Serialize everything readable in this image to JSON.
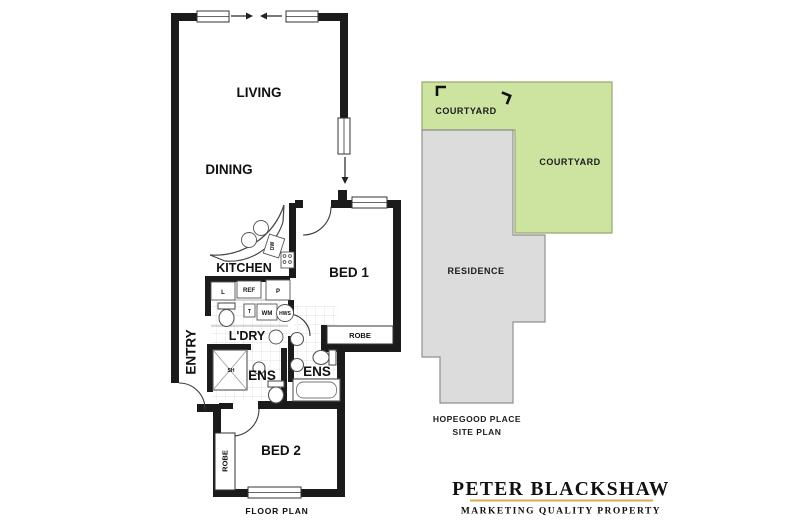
{
  "floor_plan": {
    "caption": "FLOOR PLAN",
    "rooms": {
      "living": "LIVING",
      "dining": "DINING",
      "kitchen": "KITCHEN",
      "entry": "ENTRY",
      "bed1": "BED 1",
      "bed1_robe": "ROBE",
      "laundry": "L'DRY",
      "ens1": "ENS",
      "ens2": "ENS",
      "bed2": "BED 2",
      "bed2_robe": "ROBE"
    },
    "fixtures": {
      "dishwasher": "DW",
      "linen": "L",
      "fridge": "REF",
      "pantry": "P",
      "trough": "T",
      "washing_machine": "WM",
      "hot_water": "HWS",
      "shower": "SH"
    }
  },
  "site_plan": {
    "courtyard_top_label": "COURTYARD",
    "courtyard_right_label": "COURTYARD",
    "residence_label": "RESIDENCE",
    "street_name": "HOPEGOOD PLACE",
    "caption": "SITE PLAN",
    "colors": {
      "courtyard": "#cde3a0",
      "residence": "#dcdcdc"
    }
  },
  "branding": {
    "agency_name": "PETER BLACKSHAW",
    "tagline": "MARKETING QUALITY PROPERTY",
    "colors": {
      "navy": "#27336a",
      "gold": "#dfa850"
    }
  }
}
